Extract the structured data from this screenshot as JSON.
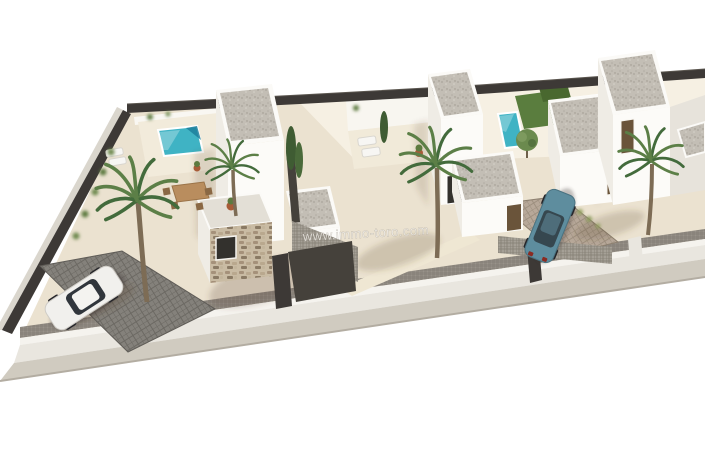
{
  "image": {
    "kind": "aerial 3D architectural render",
    "subject": "three modern white villas with private pools, palm trees, fenced plot, sidewalk and two parked cars",
    "watermark": "www.immo-toro.com"
  },
  "scene": {
    "objects": [
      "villa-left",
      "villa-middle",
      "villa-right",
      "pool-left",
      "pool-middle",
      "pool-right",
      "palm-trees",
      "cypress-trees",
      "lawn",
      "white-car",
      "blue-car",
      "driveway-left",
      "driveway-right",
      "perimeter-fence",
      "front-wall",
      "sidewalk",
      "dining-set",
      "sun-loungers",
      "plant-pots",
      "gabion-walls"
    ]
  },
  "colors": {
    "background": "#ffffff",
    "ground": "#ebe2d0",
    "ground_light": "rgba(255,252,243,0.55)",
    "wall_bright": "#fcfbf8",
    "wall_shaded": "#efece5",
    "wall_dark_side": "#e7e3db",
    "roof_gravel": "#c3beb5",
    "stone": "#c9bba3",
    "fence_dark": "#3d3936",
    "mesh_fence": "#98928a",
    "gate_dark": "#45413b",
    "sidewalk": "#d0cbc0",
    "driveway_left": "#84817b",
    "driveway_right": "#b7a899",
    "gabion": "#a5a096",
    "pool": "#3fb3c4",
    "pool_deep": "#1d7f9c",
    "pool_shallow": "#7fd0d2",
    "lawn": "#5a7d3e",
    "hedge": "#49682f",
    "palm_green": "#5c7f47",
    "palm_green_dark": "#436b3c",
    "trunk": "#7d6c55",
    "door_brown": "#6a543a",
    "window_dark": "#33312d",
    "car_white": "#f1f0ed",
    "car_blue": "#5e8d9e",
    "car_glass": "#31363c",
    "terracotta": "#a85c38",
    "watermark": "rgba(238,236,230,0.82)"
  }
}
